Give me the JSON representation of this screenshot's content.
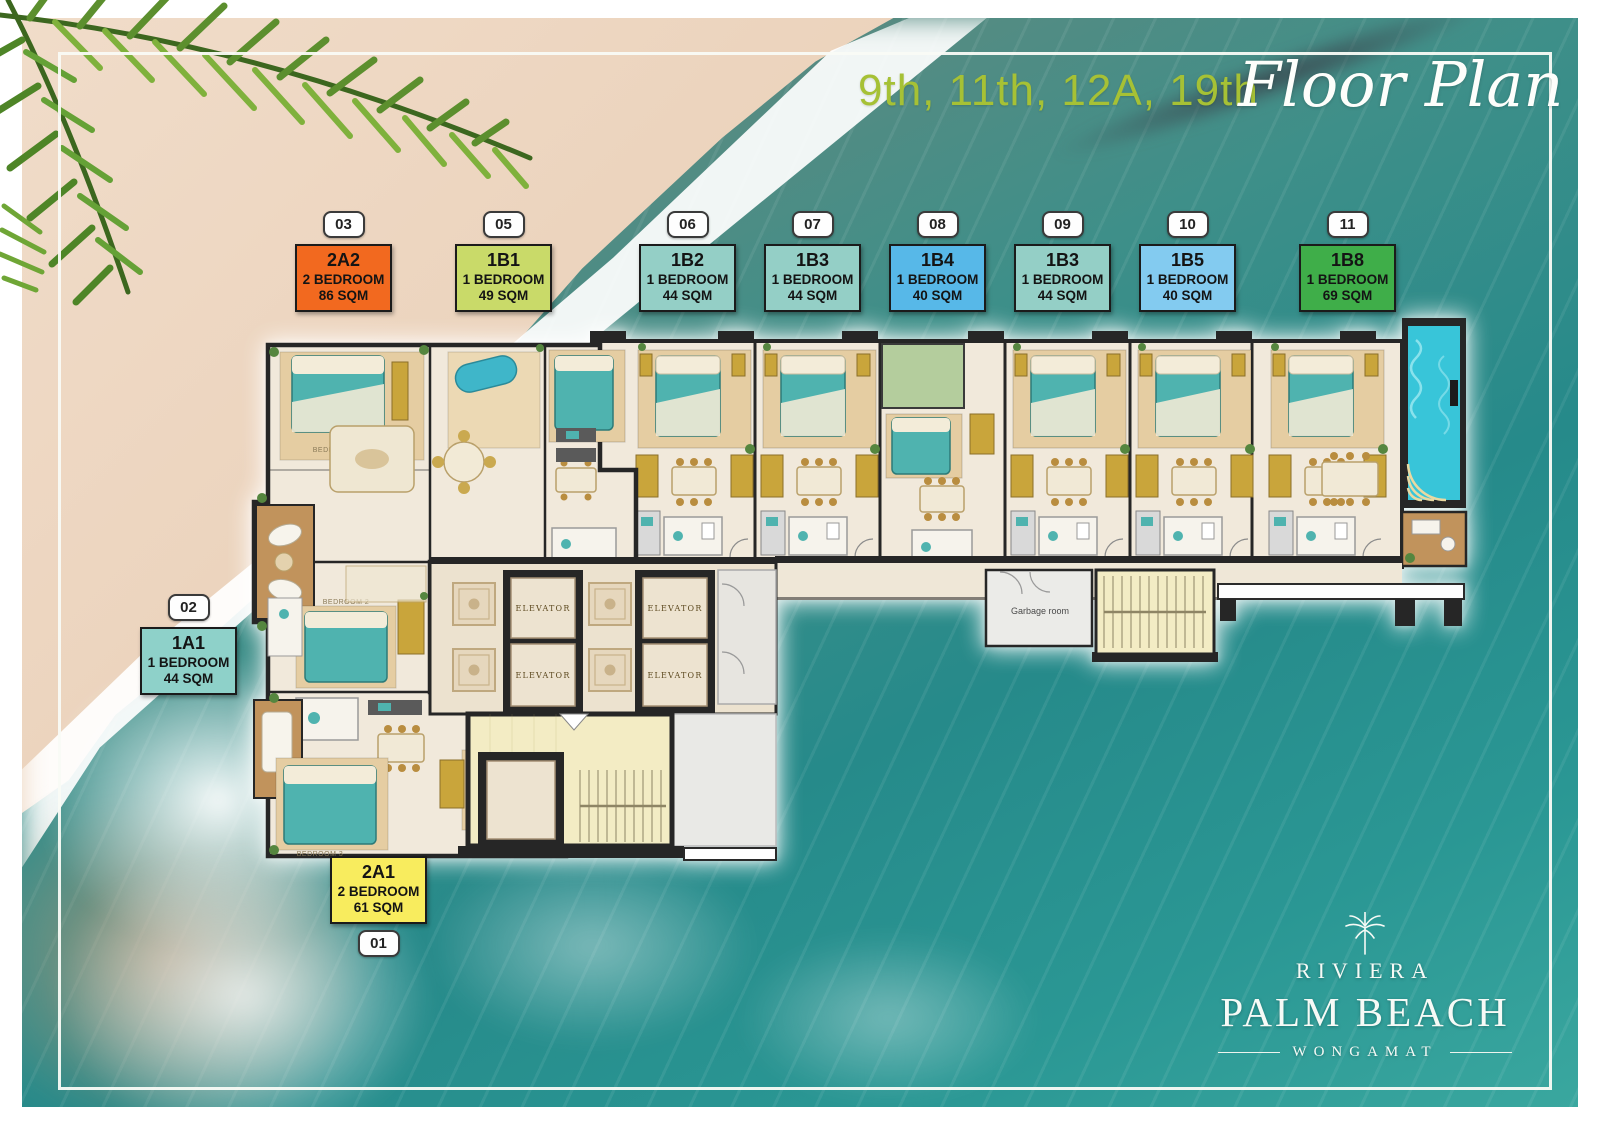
{
  "title": {
    "floors": "9th, 11th, 12A, 19th",
    "script": "Floor Plan"
  },
  "unit_labels": [
    {
      "badge": "03",
      "code": "2A2",
      "type": "2 BEDROOM",
      "area": "86 SQM",
      "color": "#f2691f"
    },
    {
      "badge": "05",
      "code": "1B1",
      "type": "1 BEDROOM",
      "area": "49 SQM",
      "color": "#c9da69"
    },
    {
      "badge": "06",
      "code": "1B2",
      "type": "1 BEDROOM",
      "area": "44 SQM",
      "color": "#94cfc6"
    },
    {
      "badge": "07",
      "code": "1B3",
      "type": "1 BEDROOM",
      "area": "44 SQM",
      "color": "#94cfc6"
    },
    {
      "badge": "08",
      "code": "1B4",
      "type": "1 BEDROOM",
      "area": "40 SQM",
      "color": "#57b8e8"
    },
    {
      "badge": "09",
      "code": "1B3",
      "type": "1 BEDROOM",
      "area": "44 SQM",
      "color": "#94cfc6"
    },
    {
      "badge": "10",
      "code": "1B5",
      "type": "1 BEDROOM",
      "area": "40 SQM",
      "color": "#83cbf0"
    },
    {
      "badge": "11",
      "code": "1B8",
      "type": "1 BEDROOM",
      "area": "69 SQM",
      "color": "#3fae49"
    },
    {
      "badge": "02",
      "code": "1A1",
      "type": "1 BEDROOM",
      "area": "44 SQM",
      "color": "#8ed1c9"
    },
    {
      "badge": "01",
      "code": "2A1",
      "type": "2 BEDROOM",
      "area": "61 SQM",
      "color": "#f8ec5e"
    }
  ],
  "floorplan": {
    "elevator": "ELEVATOR",
    "garbage_room": "Garbage room",
    "bedroom1": "BEDROOM 1",
    "bedroom2": "BEDROOM 2",
    "bedroom3": "BEDROOM 3"
  },
  "logo": {
    "brand": "RIVIERA",
    "name": "PALM BEACH",
    "location": "WONGAMAT"
  },
  "colors": {
    "title_accent": "#a6c135",
    "ocean": "#2a8f8c",
    "sand": "#ead0b8",
    "wall": "#262626"
  }
}
